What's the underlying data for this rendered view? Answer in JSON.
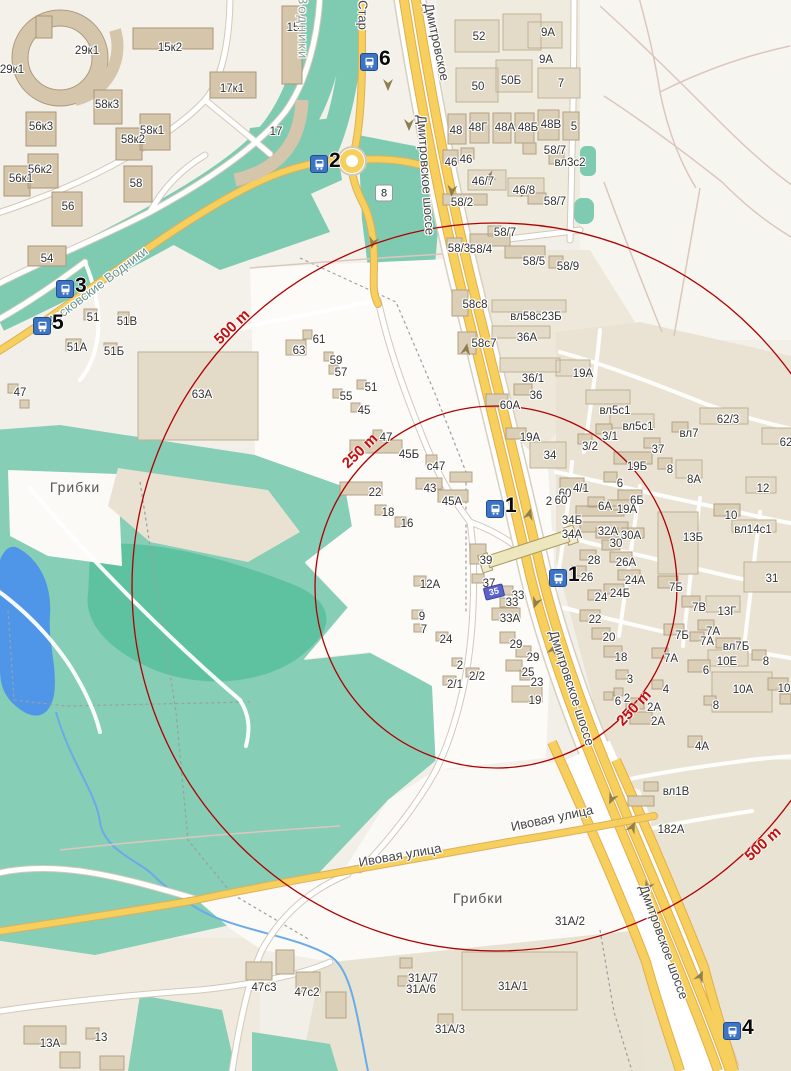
{
  "map": {
    "palette": {
      "background": "#f2efe9",
      "green": "#86ceb6",
      "green_dark": "#5ec2a0",
      "green_band": "#7ecbb2",
      "water": "#4f96e8",
      "road_yellow": "#f6cf5c",
      "road_yellow_casing": "#dcb05e",
      "road_white": "#ffffff",
      "road_casing": "#d2c9ba",
      "building": "#dbcfb8",
      "building_border": "#b3a284",
      "circle_red": "#b00000",
      "marker_blue": "#3d74c4",
      "selected_building_blue": "#5a62cc",
      "path_pink": "#ddc7bd"
    },
    "circles": {
      "cx": 496,
      "cy": 587,
      "r_250": 181,
      "r_500": 364,
      "color": "#b00000"
    },
    "distance_labels": [
      {
        "t": "250 m",
        "x": 360,
        "y": 451,
        "r": -44
      },
      {
        "t": "500 m",
        "x": 232,
        "y": 327,
        "r": -44
      },
      {
        "t": "250 m",
        "x": 634,
        "y": 708,
        "r": -47
      },
      {
        "t": "500 m",
        "x": 763,
        "y": 844,
        "r": -42
      }
    ],
    "street_labels": [
      {
        "t": "Дмитровское",
        "x": 437,
        "y": 42,
        "r": 78
      },
      {
        "t": "Дмитровское шоссе",
        "x": 426,
        "y": 175,
        "r": 86
      },
      {
        "t": "Дмитровское шоссе",
        "x": 572,
        "y": 688,
        "r": 72
      },
      {
        "t": "Дмитровское шоссе",
        "x": 664,
        "y": 942,
        "r": 70
      },
      {
        "t": "Ивовая улица",
        "x": 400,
        "y": 855,
        "r": -10
      },
      {
        "t": "Ивовая улица",
        "x": 552,
        "y": 818,
        "r": -12
      },
      {
        "t": "Московские Водники",
        "x": 96,
        "y": 287,
        "r": -37,
        "c": "#699390"
      },
      {
        "t": "Стар",
        "x": 363,
        "y": 15,
        "r": 90
      },
      {
        "t": "Водники",
        "x": 303,
        "y": 28,
        "r": 90,
        "c": "#8f9b93",
        "ls": 2
      }
    ],
    "place_labels": [
      {
        "t": "Грибки",
        "x": 75,
        "y": 487
      },
      {
        "t": "Грибки",
        "x": 478,
        "y": 898
      }
    ],
    "transit_stops": [
      {
        "label": "6",
        "x": 368,
        "y": 61
      },
      {
        "label": "2",
        "x": 318,
        "y": 163
      },
      {
        "label": "3",
        "x": 64,
        "y": 288
      },
      {
        "label": "5",
        "x": 41,
        "y": 325
      },
      {
        "label": "1",
        "x": 494,
        "y": 508
      },
      {
        "label": "1",
        "x": 557,
        "y": 577
      },
      {
        "label": "4",
        "x": 731,
        "y": 1030
      }
    ],
    "road_badges": [
      {
        "t": "8",
        "x": 384,
        "y": 193
      }
    ],
    "selected_building": {
      "t": "35",
      "x": 494,
      "y": 592
    },
    "building_labels": [
      {
        "t": "29к1",
        "x": 12,
        "y": 70
      },
      {
        "t": "29к1",
        "x": 87,
        "y": 51
      },
      {
        "t": "15к2",
        "x": 170,
        "y": 48
      },
      {
        "t": "15",
        "x": 293,
        "y": 28
      },
      {
        "t": "17к1",
        "x": 232,
        "y": 89
      },
      {
        "t": "17",
        "x": 276,
        "y": 132
      },
      {
        "t": "58к3",
        "x": 107,
        "y": 105
      },
      {
        "t": "58к1",
        "x": 152,
        "y": 131
      },
      {
        "t": "58к2",
        "x": 133,
        "y": 140
      },
      {
        "t": "56к3",
        "x": 41,
        "y": 127
      },
      {
        "t": "56к2",
        "x": 40,
        "y": 170
      },
      {
        "t": "56к1",
        "x": 21,
        "y": 179
      },
      {
        "t": "58",
        "x": 136,
        "y": 184
      },
      {
        "t": "56",
        "x": 68,
        "y": 207
      },
      {
        "t": "54",
        "x": 47,
        "y": 259
      },
      {
        "t": "51",
        "x": 93,
        "y": 318
      },
      {
        "t": "51В",
        "x": 127,
        "y": 322
      },
      {
        "t": "51А",
        "x": 77,
        "y": 348
      },
      {
        "t": "51Б",
        "x": 114,
        "y": 352
      },
      {
        "t": "47",
        "x": 20,
        "y": 393
      },
      {
        "t": "63А",
        "x": 202,
        "y": 395
      },
      {
        "t": "52",
        "x": 479,
        "y": 37
      },
      {
        "t": "9А",
        "x": 548,
        "y": 33
      },
      {
        "t": "9А",
        "x": 546,
        "y": 60
      },
      {
        "t": "50",
        "x": 478,
        "y": 87
      },
      {
        "t": "50Б",
        "x": 511,
        "y": 81
      },
      {
        "t": "7",
        "x": 561,
        "y": 84
      },
      {
        "t": "48",
        "x": 456,
        "y": 131
      },
      {
        "t": "48Г",
        "x": 478,
        "y": 128
      },
      {
        "t": "48А",
        "x": 505,
        "y": 128
      },
      {
        "t": "48Б",
        "x": 528,
        "y": 128
      },
      {
        "t": "48В",
        "x": 551,
        "y": 125
      },
      {
        "t": "5",
        "x": 574,
        "y": 127
      },
      {
        "t": "46",
        "x": 451,
        "y": 163
      },
      {
        "t": "46",
        "x": 466,
        "y": 160
      },
      {
        "t": "58/7",
        "x": 555,
        "y": 151
      },
      {
        "t": "вл3с2",
        "x": 570,
        "y": 163
      },
      {
        "t": "46/7",
        "x": 483,
        "y": 182
      },
      {
        "t": "46/8",
        "x": 524,
        "y": 191
      },
      {
        "t": "58/2",
        "x": 462,
        "y": 203
      },
      {
        "t": "58/7",
        "x": 555,
        "y": 202
      },
      {
        "t": "58/7",
        "x": 505,
        "y": 233
      },
      {
        "t": "58/3",
        "x": 459,
        "y": 249
      },
      {
        "t": "58/4",
        "x": 481,
        "y": 250
      },
      {
        "t": "58/5",
        "x": 534,
        "y": 262
      },
      {
        "t": "58/9",
        "x": 568,
        "y": 267
      },
      {
        "t": "58с8",
        "x": 475,
        "y": 305
      },
      {
        "t": "вл58с23Б",
        "x": 536,
        "y": 317
      },
      {
        "t": "36А",
        "x": 527,
        "y": 338
      },
      {
        "t": "58с7",
        "x": 484,
        "y": 344
      },
      {
        "t": "36/1",
        "x": 533,
        "y": 379
      },
      {
        "t": "36",
        "x": 536,
        "y": 396
      },
      {
        "t": "60А",
        "x": 510,
        "y": 406
      },
      {
        "t": "19А",
        "x": 583,
        "y": 374
      },
      {
        "t": "19А",
        "x": 530,
        "y": 438
      },
      {
        "t": "34",
        "x": 550,
        "y": 456
      },
      {
        "t": "вл5с1",
        "x": 615,
        "y": 411
      },
      {
        "t": "вл5с1",
        "x": 638,
        "y": 427
      },
      {
        "t": "3/1",
        "x": 610,
        "y": 437
      },
      {
        "t": "3/2",
        "x": 590,
        "y": 447
      },
      {
        "t": "62/3",
        "x": 728,
        "y": 420
      },
      {
        "t": "вл7",
        "x": 689,
        "y": 434
      },
      {
        "t": "37",
        "x": 658,
        "y": 450
      },
      {
        "t": "62",
        "x": 786,
        "y": 443
      },
      {
        "t": "19Б",
        "x": 637,
        "y": 467
      },
      {
        "t": "8",
        "x": 670,
        "y": 470
      },
      {
        "t": "8А",
        "x": 694,
        "y": 480
      },
      {
        "t": "12",
        "x": 763,
        "y": 489
      },
      {
        "t": "6",
        "x": 620,
        "y": 484
      },
      {
        "t": "4/1",
        "x": 581,
        "y": 489
      },
      {
        "t": "60",
        "x": 565,
        "y": 494
      },
      {
        "t": "60",
        "x": 561,
        "y": 501
      },
      {
        "t": "2",
        "x": 549,
        "y": 502
      },
      {
        "t": "6Б",
        "x": 637,
        "y": 501
      },
      {
        "t": "6А",
        "x": 605,
        "y": 507
      },
      {
        "t": "19А",
        "x": 627,
        "y": 510
      },
      {
        "t": "34Б",
        "x": 572,
        "y": 521
      },
      {
        "t": "34А",
        "x": 572,
        "y": 535
      },
      {
        "t": "32А",
        "x": 608,
        "y": 532
      },
      {
        "t": "30А",
        "x": 631,
        "y": 536
      },
      {
        "t": "30",
        "x": 616,
        "y": 544
      },
      {
        "t": "10",
        "x": 731,
        "y": 516
      },
      {
        "t": "вл14с1",
        "x": 753,
        "y": 530
      },
      {
        "t": "13Б",
        "x": 693,
        "y": 538
      },
      {
        "t": "28",
        "x": 594,
        "y": 561
      },
      {
        "t": "26А",
        "x": 626,
        "y": 563
      },
      {
        "t": "26",
        "x": 587,
        "y": 578
      },
      {
        "t": "24А",
        "x": 635,
        "y": 581
      },
      {
        "t": "24Б",
        "x": 620,
        "y": 594
      },
      {
        "t": "24",
        "x": 601,
        "y": 598
      },
      {
        "t": "31",
        "x": 772,
        "y": 579
      },
      {
        "t": "22",
        "x": 595,
        "y": 620
      },
      {
        "t": "20",
        "x": 609,
        "y": 638
      },
      {
        "t": "18",
        "x": 621,
        "y": 658
      },
      {
        "t": "3",
        "x": 630,
        "y": 680
      },
      {
        "t": "7Б",
        "x": 676,
        "y": 588
      },
      {
        "t": "7В",
        "x": 699,
        "y": 608
      },
      {
        "t": "13Г",
        "x": 727,
        "y": 612
      },
      {
        "t": "7Б",
        "x": 682,
        "y": 636
      },
      {
        "t": "7А",
        "x": 713,
        "y": 632
      },
      {
        "t": "7А",
        "x": 707,
        "y": 642
      },
      {
        "t": "вл7Б",
        "x": 736,
        "y": 647
      },
      {
        "t": "7А",
        "x": 671,
        "y": 659
      },
      {
        "t": "10Е",
        "x": 727,
        "y": 662
      },
      {
        "t": "8",
        "x": 766,
        "y": 662
      },
      {
        "t": "6",
        "x": 706,
        "y": 671
      },
      {
        "t": "10А",
        "x": 743,
        "y": 690
      },
      {
        "t": "10",
        "x": 784,
        "y": 689
      },
      {
        "t": "4",
        "x": 666,
        "y": 690
      },
      {
        "t": "6",
        "x": 618,
        "y": 702
      },
      {
        "t": "2",
        "x": 627,
        "y": 699
      },
      {
        "t": "2А",
        "x": 654,
        "y": 708
      },
      {
        "t": "8",
        "x": 716,
        "y": 706
      },
      {
        "t": "2А",
        "x": 658,
        "y": 722
      },
      {
        "t": "4А",
        "x": 702,
        "y": 747
      },
      {
        "t": "вл1В",
        "x": 676,
        "y": 792
      },
      {
        "t": "182А",
        "x": 671,
        "y": 830
      },
      {
        "t": "63",
        "x": 299,
        "y": 351
      },
      {
        "t": "61",
        "x": 319,
        "y": 340
      },
      {
        "t": "59",
        "x": 336,
        "y": 361
      },
      {
        "t": "57",
        "x": 341,
        "y": 373
      },
      {
        "t": "51",
        "x": 371,
        "y": 388
      },
      {
        "t": "55",
        "x": 346,
        "y": 397
      },
      {
        "t": "45",
        "x": 364,
        "y": 411
      },
      {
        "t": "47",
        "x": 386,
        "y": 438
      },
      {
        "t": "45Б",
        "x": 409,
        "y": 455
      },
      {
        "t": "с47",
        "x": 436,
        "y": 467
      },
      {
        "t": "22",
        "x": 375,
        "y": 493
      },
      {
        "t": "43",
        "x": 430,
        "y": 489
      },
      {
        "t": "45А",
        "x": 452,
        "y": 502
      },
      {
        "t": "18",
        "x": 388,
        "y": 513
      },
      {
        "t": "16",
        "x": 407,
        "y": 524
      },
      {
        "t": "39",
        "x": 486,
        "y": 561
      },
      {
        "t": "12А",
        "x": 430,
        "y": 585
      },
      {
        "t": "37",
        "x": 489,
        "y": 584
      },
      {
        "t": "33",
        "x": 518,
        "y": 596
      },
      {
        "t": "33",
        "x": 512,
        "y": 603
      },
      {
        "t": "33А",
        "x": 510,
        "y": 619
      },
      {
        "t": "9",
        "x": 422,
        "y": 617
      },
      {
        "t": "7",
        "x": 424,
        "y": 630
      },
      {
        "t": "24",
        "x": 446,
        "y": 640
      },
      {
        "t": "29",
        "x": 516,
        "y": 645
      },
      {
        "t": "29",
        "x": 533,
        "y": 658
      },
      {
        "t": "2",
        "x": 460,
        "y": 666
      },
      {
        "t": "2/2",
        "x": 477,
        "y": 677
      },
      {
        "t": "2/1",
        "x": 455,
        "y": 685
      },
      {
        "t": "25",
        "x": 528,
        "y": 673
      },
      {
        "t": "23",
        "x": 537,
        "y": 683
      },
      {
        "t": "19",
        "x": 535,
        "y": 701
      },
      {
        "t": "31А/2",
        "x": 570,
        "y": 922
      },
      {
        "t": "31А/7",
        "x": 423,
        "y": 979
      },
      {
        "t": "31А/6",
        "x": 421,
        "y": 990
      },
      {
        "t": "31А/1",
        "x": 513,
        "y": 987
      },
      {
        "t": "31А/3",
        "x": 450,
        "y": 1030
      },
      {
        "t": "47с3",
        "x": 264,
        "y": 988
      },
      {
        "t": "47с2",
        "x": 307,
        "y": 993
      },
      {
        "t": "13А",
        "x": 50,
        "y": 1044
      },
      {
        "t": "13",
        "x": 101,
        "y": 1038
      }
    ]
  }
}
